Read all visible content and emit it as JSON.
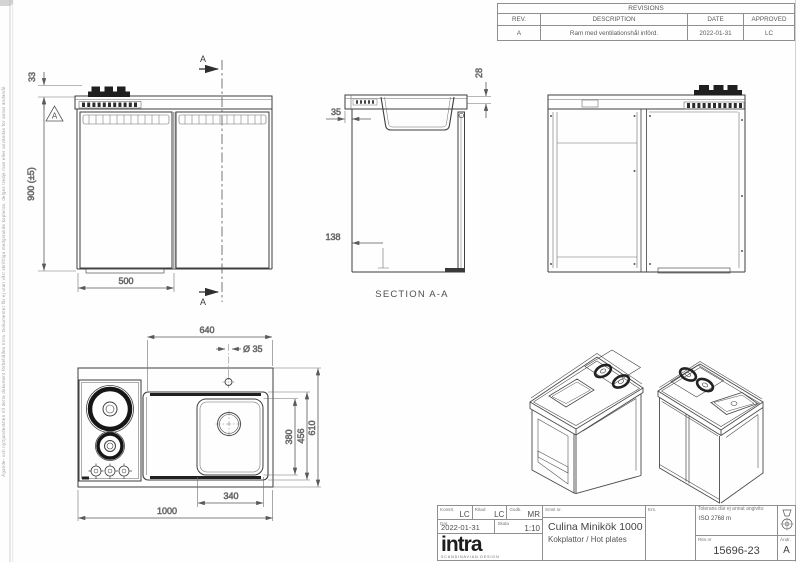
{
  "sheet": {
    "edge_note": "Ägande- och nyttjanderätten till detta dokument förbehålles Intra. Dokumentet får ej utan vårt skriftliga medgivande kopieras, delges tredje man eller användas för annat ändamål."
  },
  "revisions": {
    "title": "REVISIONS",
    "headers": [
      "REV.",
      "DESCRIPTION",
      "DATE",
      "APPROVED"
    ],
    "rows": [
      {
        "rev": "A",
        "description": "Ram med ventilationshål införd.",
        "date": "2022-01-31",
        "approved": "LC"
      }
    ]
  },
  "views": {
    "front": {
      "dim_hob_height": "33",
      "dim_height": "900 (±5)",
      "dim_door_width": "500",
      "section_mark": "A",
      "revision_flag": "A"
    },
    "section": {
      "label": "SECTION A-A",
      "dim_top": "28",
      "dim_overhang": "35",
      "dim_plinth": "138"
    },
    "plan": {
      "dim_sink_section": "640",
      "dim_hole": "Ø 35",
      "dim_bowl_depth": "380",
      "dim_module_depth": "456",
      "dim_total_depth": "610",
      "dim_bowl_width": "340",
      "dim_total_width": "1000"
    }
  },
  "title_block": {
    "konstr_label": "Konstr.",
    "konstr": "LC",
    "ritad_label": "Ritad",
    "ritad": "LC",
    "godk_label": "Godk.",
    "godk": "MR",
    "smst_label": "Smst nr.",
    "dat_label": "Dat.",
    "dat": "2022-01-31",
    "skala_label": "Skala",
    "skala": "1:10",
    "ers_label": "Ers.",
    "title": "Culina Minikök 1000",
    "subtitle": "Kokplattor / Hot plates",
    "tolerance_label": "Tolerans där ej annat angivits:",
    "tolerance_value": "ISO 2768 m",
    "drawing_no_label": "Ritn.nr",
    "drawing_no": "15696-23",
    "rev_label": "Ändr.",
    "rev": "A",
    "logo": "intra",
    "logo_tagline": "SCANDINAVIAN DESIGN"
  }
}
